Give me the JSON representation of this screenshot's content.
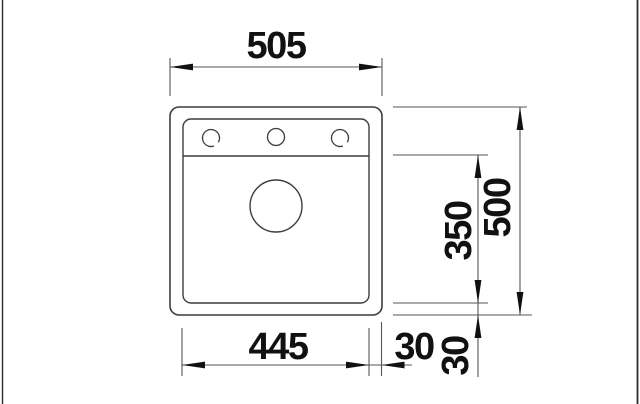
{
  "drawing": {
    "type": "technical-dimension-drawing",
    "subject": "sink-top-view",
    "units": "mm",
    "labels": {
      "overall_width": "505",
      "overall_depth": "500",
      "bowl_width": "445",
      "bowl_depth": "350",
      "side_offset": "30",
      "bottom_offset": "30"
    },
    "colors": {
      "background": "#ffffff",
      "outline": "#3d3d3d",
      "dimension_line": "#555555",
      "arrow_and_text": "#111111",
      "frame_edge": "#2a2a2a"
    },
    "features": {
      "tap_holes": 3,
      "drain": "circle"
    }
  }
}
